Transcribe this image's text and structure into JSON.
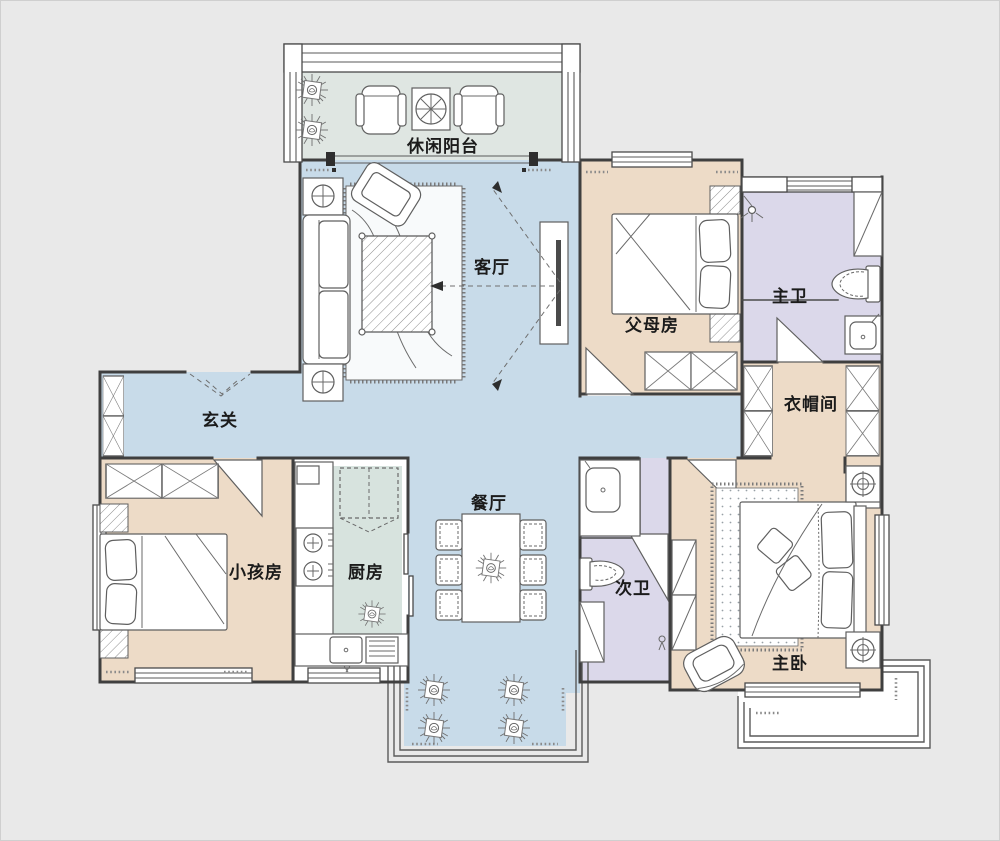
{
  "colors": {
    "background": "#e9e9e9",
    "floor_public": "#c8dbe9",
    "floor_bedroom": "#eddbc7",
    "floor_bath": "#dbd8ea",
    "floor_balcony": "#dfe6e2",
    "floor_kitchen": "#d7e3de",
    "wall": "#3f3f3f"
  },
  "rooms": [
    {
      "id": "leisure-balcony",
      "label": "休闲阳台"
    },
    {
      "id": "living-room",
      "label": "客厅"
    },
    {
      "id": "parents-room",
      "label": "父母房"
    },
    {
      "id": "master-bath",
      "label": "主卫"
    },
    {
      "id": "cloakroom",
      "label": "衣帽间"
    },
    {
      "id": "entrance-hall",
      "label": "玄关"
    },
    {
      "id": "kids-room",
      "label": "小孩房"
    },
    {
      "id": "kitchen",
      "label": "厨房"
    },
    {
      "id": "dining-room",
      "label": "餐厅"
    },
    {
      "id": "second-bath",
      "label": "次卫"
    },
    {
      "id": "master-bedroom",
      "label": "主卧"
    }
  ]
}
